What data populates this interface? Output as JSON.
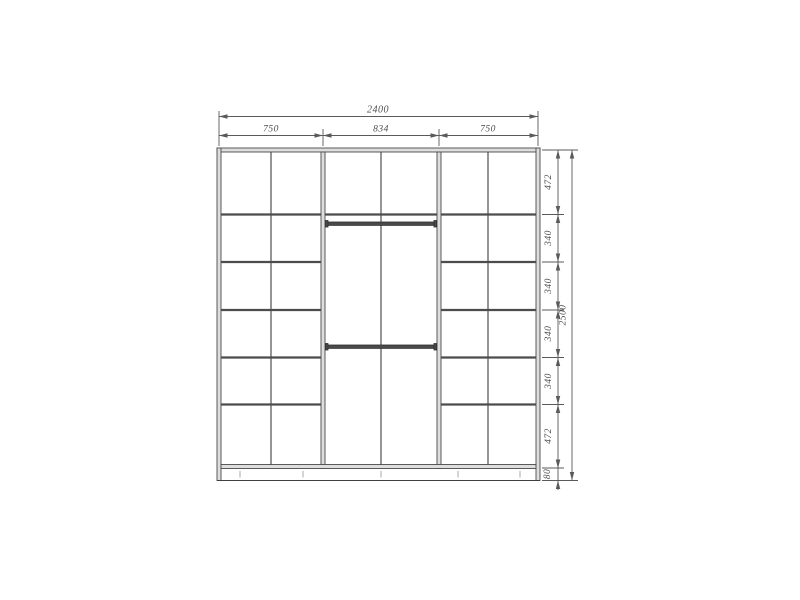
{
  "diagram": {
    "type": "furniture-technical-drawing",
    "subject": "wardrobe-front-elevation",
    "colors": {
      "background": "#ffffff",
      "line": "#3f3f3f",
      "panel_fill": "#dedede",
      "dimension": "#4d4d4d"
    },
    "dimensions": {
      "top": {
        "total": "2400",
        "sections": [
          "750",
          "834",
          "750"
        ]
      },
      "right": {
        "total": "2500",
        "rows": [
          "472",
          "340",
          "340",
          "340",
          "340",
          "472"
        ],
        "plinth": "80"
      }
    }
  }
}
